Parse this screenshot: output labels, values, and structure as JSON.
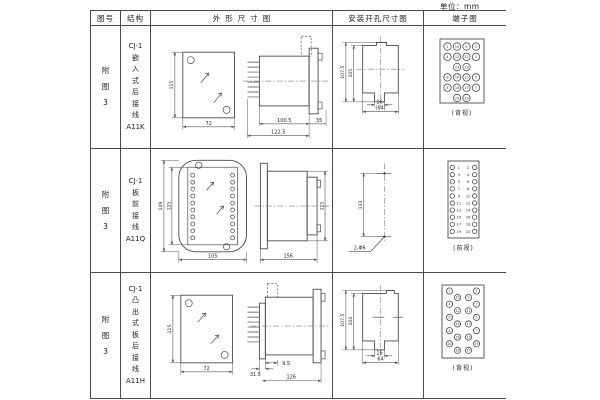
{
  "unit_label": "单位：mm",
  "headers": {
    "fig_no": "图号",
    "structure": "结构",
    "outline": "外形尺寸图",
    "mounting": "安装开孔尺寸图",
    "terminal": "端子图"
  },
  "rows": [
    {
      "fig_no_lines": [
        "附",
        "图",
        "3"
      ],
      "structure_lines": [
        "CJ-1",
        "嵌",
        "入",
        "式",
        "后",
        "接",
        "线",
        "A11K"
      ],
      "outline": {
        "front_height": "115",
        "front_width": "72",
        "body_depth": "100.5",
        "total_depth": "122.5",
        "flange_depth": "35"
      },
      "mounting": {
        "outer_height": "107.5",
        "inner_height": "105",
        "notch_width": "16",
        "opening_width": "(64)"
      },
      "terminal": {
        "type": "grid4",
        "rows": [
          [
            "2",
            "10",
            "9",
            "1"
          ],
          [
            "4",
            "12",
            "11",
            "3"
          ],
          [
            "",
            "14",
            "13",
            ""
          ],
          [
            "6",
            "16",
            "15",
            "5"
          ],
          [
            "8",
            "18",
            "17",
            "7"
          ],
          [
            "",
            "20",
            "19",
            ""
          ]
        ],
        "caption": "(背视)"
      }
    },
    {
      "fig_no_lines": [
        "附",
        "图",
        "3"
      ],
      "structure_lines": [
        "CJ-1",
        "板",
        "前",
        "接",
        "线",
        "A11Q"
      ],
      "outline": {
        "front_height": "149",
        "inner_height": "125",
        "front_width": "105",
        "body_depth": "156",
        "side_height": "115"
      },
      "mounting": {
        "hole_pitch": "133",
        "hole_spec": "2-Φ6"
      },
      "terminal": {
        "type": "pairs",
        "left_numbers": [
          "1",
          "3",
          "5",
          "7",
          "9",
          "11",
          "13",
          "15",
          "17",
          "19"
        ],
        "right_numbers": [
          "2",
          "4",
          "6",
          "8",
          "10",
          "12",
          "14",
          "16",
          "18",
          "20"
        ],
        "caption": "(前视)"
      }
    },
    {
      "fig_no_lines": [
        "附",
        "图",
        "3"
      ],
      "structure_lines": [
        "CJ-1",
        "凸",
        "出",
        "式",
        "板",
        "后",
        "接",
        "线",
        "A11H"
      ],
      "outline": {
        "front_height": "115",
        "front_width": "72",
        "pin_depth": "31.5",
        "gap_depth": "9.5",
        "body_depth": "126"
      },
      "mounting": {
        "outer_height": "107.5",
        "inner_height": "104",
        "notch_width": "16",
        "opening_width": "64"
      },
      "terminal": {
        "type": "stagger",
        "outer_left": [
          "2",
          "4",
          "6",
          "8",
          "20"
        ],
        "inner_left": [
          "10",
          "12",
          "14",
          "16",
          "18"
        ],
        "inner_right": [
          "9",
          "11",
          "13",
          "15",
          "17"
        ],
        "outer_right": [
          "1",
          "3",
          "5",
          "7",
          "19"
        ],
        "caption": "(背视)"
      }
    }
  ]
}
